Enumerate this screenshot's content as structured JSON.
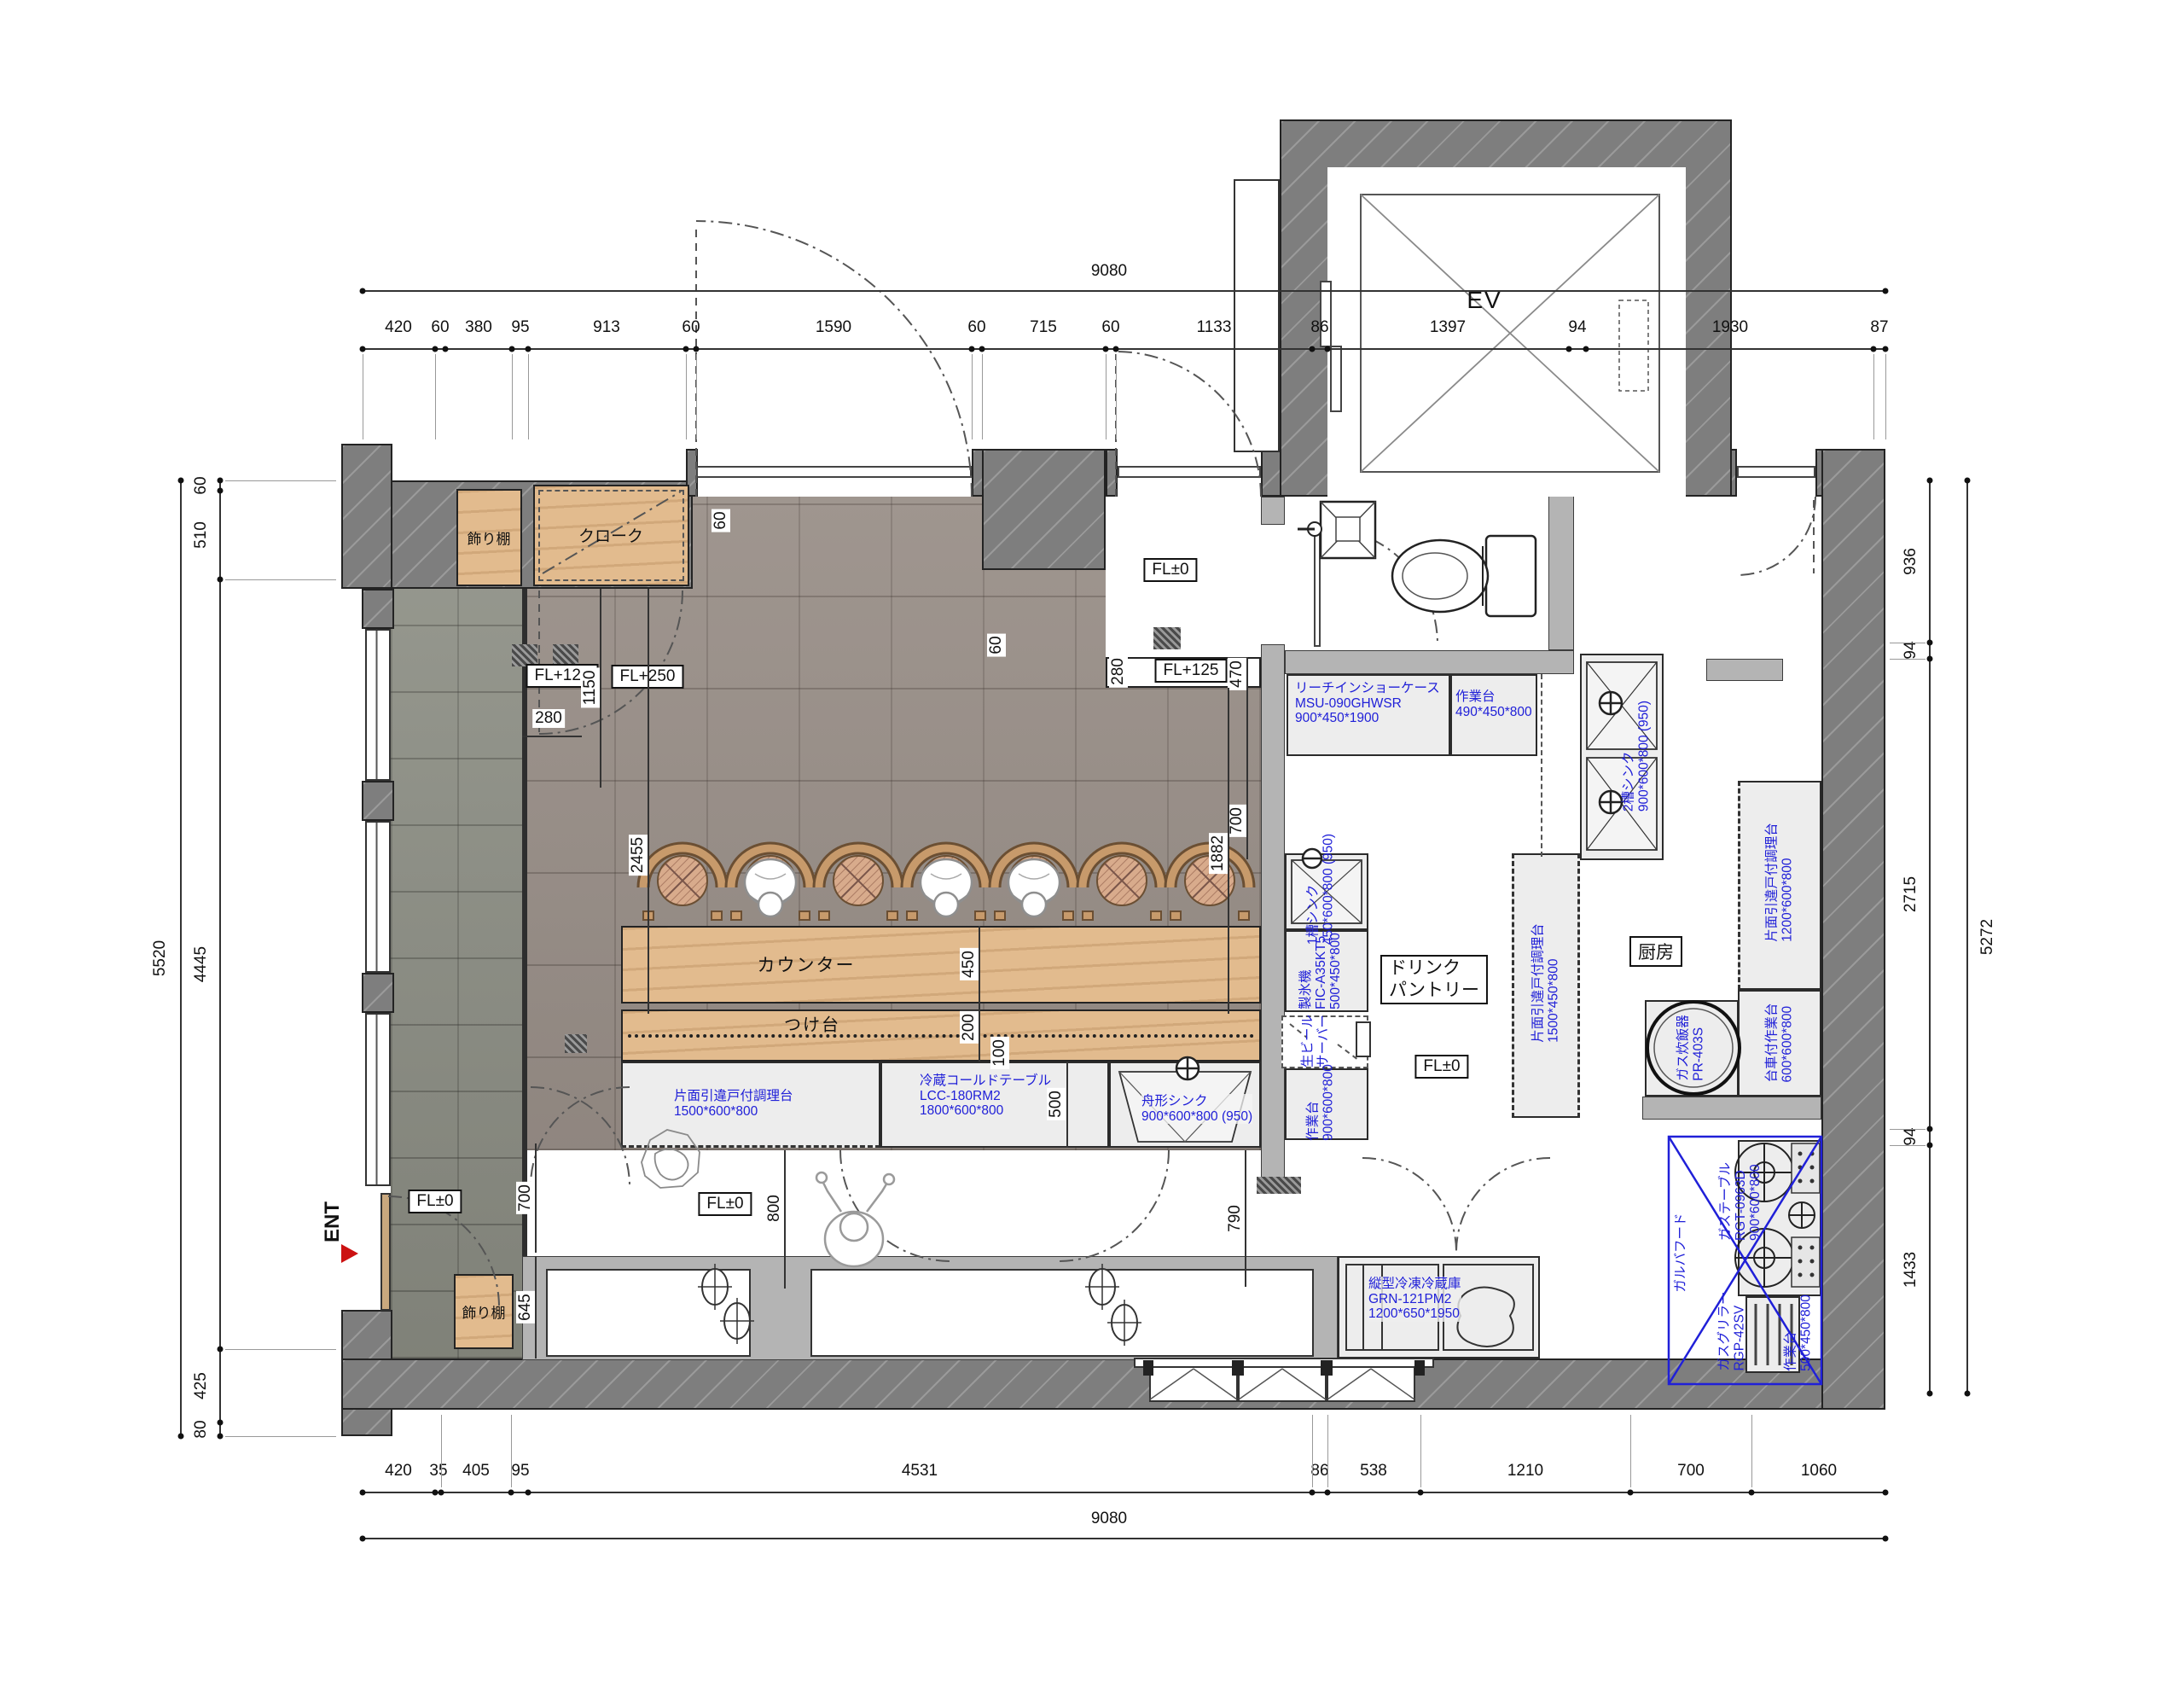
{
  "drawing": {
    "type": "restaurant floor plan",
    "labels": {
      "ev": "EV",
      "ent": "ENT",
      "counter": "カウンター",
      "tsukedai": "つけ台",
      "kitchen": "厨房",
      "drink1": "ドリンク",
      "drink2": "パントリー",
      "cloak": "クローク",
      "shelf": "飾り棚",
      "fl0": "FL±0",
      "fl125": "FL+125",
      "fl250": "FL+250"
    },
    "colors": {
      "wall": "#7e7e7e",
      "light_wall": "#b4b4b4",
      "dining_tile": "#9a9089",
      "corridor_tile": "#8e9086",
      "wood": "#e2bb8e",
      "equipment": "#ededed",
      "label_blue": "#2020d8",
      "ent_red": "#cc1111"
    },
    "eq": {
      "e0": {
        "l1": "片面引違戸付調理台",
        "l2": "1500*600*800"
      },
      "e1": {
        "l1": "冷蔵コールドテーブル",
        "l2": "LCC-180RM2",
        "l3": "1800*600*800"
      },
      "e2": {
        "l1": "舟形シンク",
        "l2": "900*600*800 (950)"
      },
      "e3": {
        "l1": "リーチインショーケース",
        "l2": "MSU-090GHWSR",
        "l3": "900*450*1900"
      },
      "e4": {
        "l1": "作業台",
        "l2": "490*450*800"
      },
      "e5": {
        "l1": "2槽シンク",
        "l2": "900*600*800 (950)"
      },
      "e6": {
        "l1": "1槽シンク",
        "l2": "450*600*800 (950)"
      },
      "e7": {
        "l1": "製氷機",
        "l2": "FIC-A35KT5",
        "l3": "500*450*800"
      },
      "e8": {
        "l1": "片面引違戸付調理台",
        "l2": "1500*450*800"
      },
      "e9": {
        "l1": "片面引違戸付調理台",
        "l2": "1200*600*800"
      },
      "e10": {
        "l1": "台車付作業台",
        "l2": "600*600*800"
      },
      "e11": {
        "l1": "ガス炊飯器",
        "l2": "PR-403S"
      },
      "e12": {
        "l1": "ガステーブル",
        "l2": "RGT-0963D",
        "l3": "900*600*800"
      },
      "e13": {
        "l1": "ガスグリラー",
        "l2": "RGP-42SV"
      },
      "e14": {
        "l1": "作業台",
        "l2": "500*450*800"
      },
      "e15": {
        "l1": "ガルバフード"
      },
      "e16": {
        "l1": "生ビール",
        "l2": "サーバー"
      },
      "e17": {
        "l1": "作業台",
        "l2": "900*600*800"
      },
      "e18": {
        "l1": "縦型冷凍冷蔵庫",
        "l2": "GRN-121PM2",
        "l3": "1200*650*1950"
      }
    },
    "dims": {
      "overall_w": "9080",
      "overall_h_left": "5520",
      "overall_h_right": "5272",
      "top": [
        "420",
        "60",
        "380",
        "95",
        "913",
        "60",
        "1590",
        "60",
        "715",
        "60",
        "1133",
        "86",
        "1397",
        "94",
        "1930",
        "87"
      ],
      "bottom": [
        "420",
        "35",
        "405",
        "95",
        "4531",
        "86",
        "538",
        "1210",
        "700",
        "1060"
      ],
      "left": [
        "60",
        "510",
        "4445",
        "425",
        "80"
      ],
      "right": [
        "936",
        "94",
        "2715",
        "94",
        "1433"
      ],
      "d1150": "1150",
      "d280a": "280",
      "d280b": "280",
      "d60a": "60",
      "d60b": "60",
      "d470": "470",
      "d700a": "700",
      "d700b": "700",
      "d645": "645",
      "d2455": "2455",
      "d450": "450",
      "d200": "200",
      "d100": "100",
      "d500": "500",
      "d1882": "1882",
      "d800": "800",
      "d790": "790"
    }
  }
}
